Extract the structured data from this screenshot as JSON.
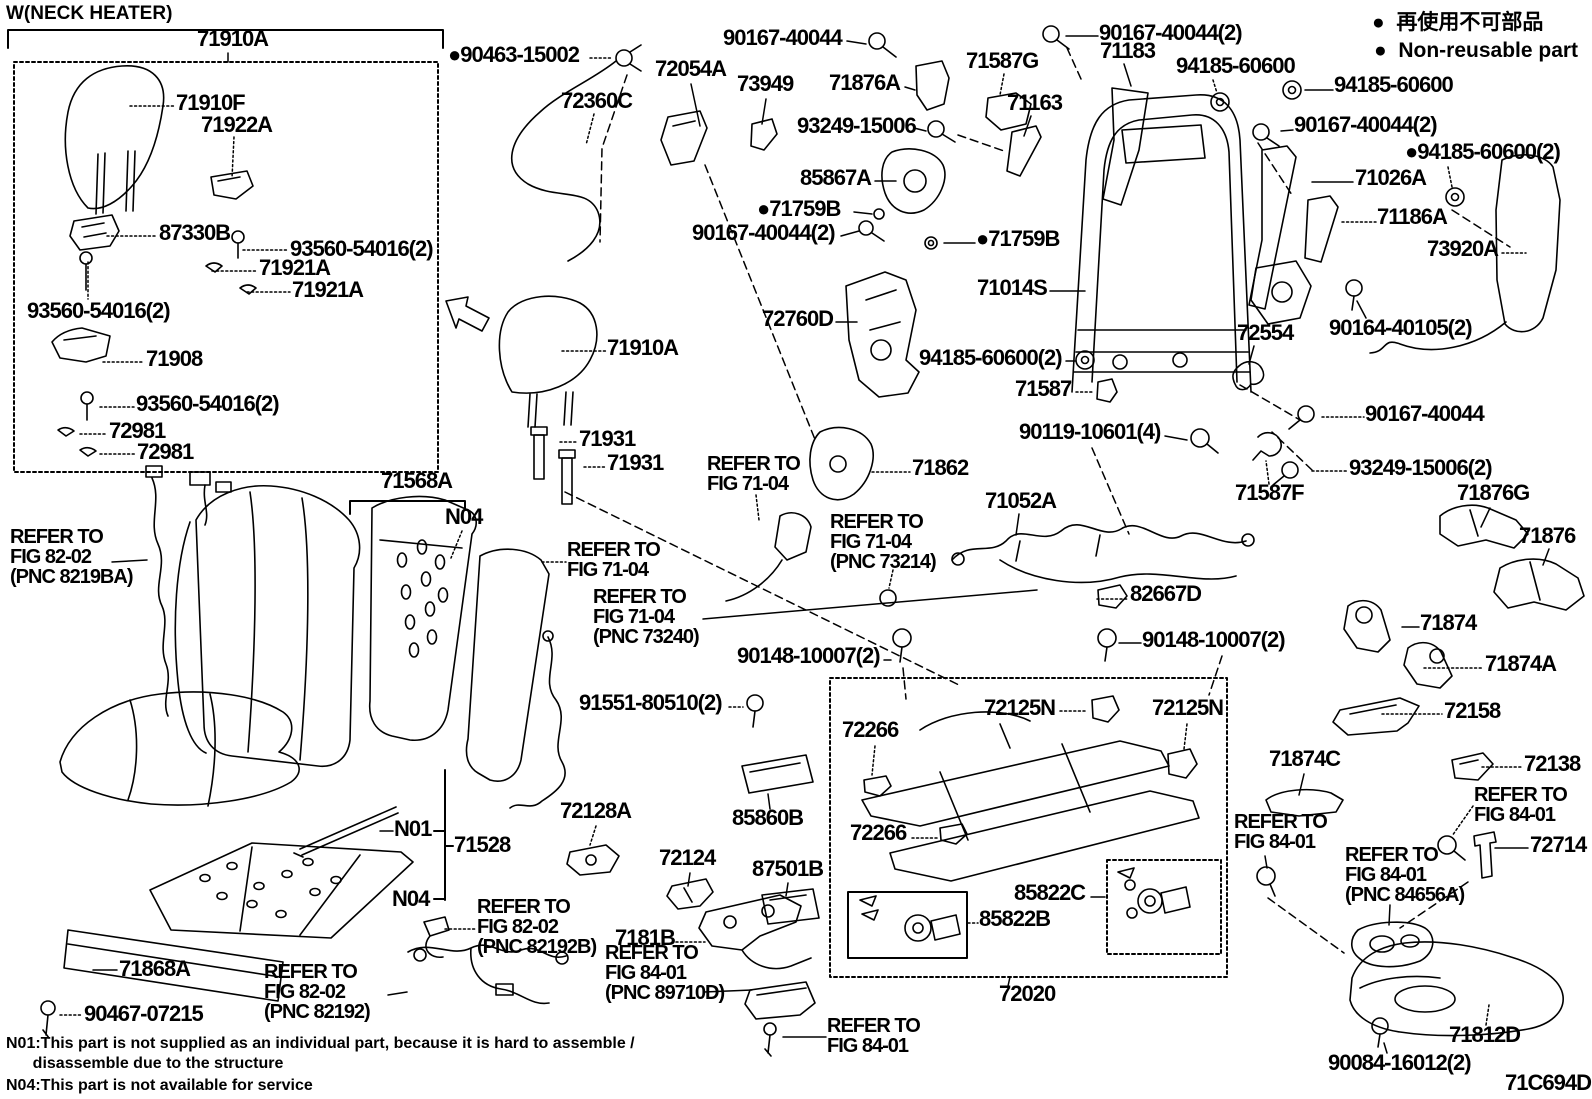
{
  "diagram_title": "Front seat & seat track exploded parts diagram",
  "figure_code": "71C694D",
  "colors": {
    "ink": "#000000",
    "background": "#ffffff"
  },
  "labels": [
    {
      "n": "title-neck-heater",
      "t": "W(NECK HEATER)",
      "x": 6,
      "y": 4,
      "fs": 19,
      "ls": 0
    },
    {
      "n": "part-71910A",
      "t": "71910A",
      "x": 197,
      "y": 28
    },
    {
      "n": "part-71910F",
      "t": "71910F",
      "x": 176,
      "y": 92
    },
    {
      "n": "part-71922A",
      "t": "71922A",
      "x": 201,
      "y": 114
    },
    {
      "n": "part-87330B",
      "t": "87330B",
      "x": 159,
      "y": 222
    },
    {
      "n": "part-93560-54016",
      "t": "93560-54016(2)",
      "x": 290,
      "y": 238
    },
    {
      "n": "part-71921A",
      "t": "71921A",
      "x": 259,
      "y": 257
    },
    {
      "n": "part-71921A",
      "t": "71921A",
      "x": 292,
      "y": 279
    },
    {
      "n": "part-93560-54016",
      "t": "93560-54016(2)",
      "x": 27,
      "y": 300
    },
    {
      "n": "part-71908",
      "t": "71908",
      "x": 146,
      "y": 348
    },
    {
      "n": "part-93560-54016",
      "t": "93560-54016(2)",
      "x": 136,
      "y": 393
    },
    {
      "n": "part-72981",
      "t": "72981",
      "x": 109,
      "y": 420
    },
    {
      "n": "part-72981",
      "t": "72981",
      "x": 137,
      "y": 441
    },
    {
      "n": "part-90463-15002",
      "t": "●90463-15002",
      "x": 448,
      "y": 44
    },
    {
      "n": "part-72360C",
      "t": "72360C",
      "x": 561,
      "y": 90
    },
    {
      "n": "part-72054A",
      "t": "72054A",
      "x": 655,
      "y": 58
    },
    {
      "n": "part-73949",
      "t": "73949",
      "x": 737,
      "y": 73
    },
    {
      "n": "part-90167-40044",
      "t": "90167-40044",
      "x": 723,
      "y": 27
    },
    {
      "n": "part-71876A",
      "t": "71876A",
      "x": 829,
      "y": 72
    },
    {
      "n": "part-71587G",
      "t": "71587G",
      "x": 966,
      "y": 50
    },
    {
      "n": "part-93249-15006",
      "t": "93249-15006",
      "x": 797,
      "y": 115
    },
    {
      "n": "part-71163",
      "t": "71163",
      "x": 1007,
      "y": 92
    },
    {
      "n": "part-85867A",
      "t": "85867A",
      "x": 800,
      "y": 167
    },
    {
      "n": "part-71759B",
      "t": "●71759B",
      "x": 757,
      "y": 198
    },
    {
      "n": "part-90167-40044",
      "t": "90167-40044(2)",
      "x": 692,
      "y": 222
    },
    {
      "n": "part-71759B",
      "t": "●71759B",
      "x": 976,
      "y": 228
    },
    {
      "n": "part-71183",
      "t": "71183",
      "x": 1100,
      "y": 40
    },
    {
      "n": "part-90167-40044",
      "t": "90167-40044(2)",
      "x": 1099,
      "y": 22
    },
    {
      "n": "part-94185-60600",
      "t": "94185-60600",
      "x": 1176,
      "y": 55
    },
    {
      "n": "part-94185-60600",
      "t": "94185-60600",
      "x": 1334,
      "y": 74
    },
    {
      "n": "part-90167-40044",
      "t": "90167-40044(2)",
      "x": 1294,
      "y": 114
    },
    {
      "n": "part-94185-60600",
      "t": "●94185-60600(2)",
      "x": 1405,
      "y": 141
    },
    {
      "n": "part-71026A",
      "t": "71026A",
      "x": 1355,
      "y": 167
    },
    {
      "n": "part-71186A",
      "t": "71186A",
      "x": 1377,
      "y": 206
    },
    {
      "n": "part-73920A",
      "t": "73920A",
      "x": 1427,
      "y": 238
    },
    {
      "n": "legend-non-reusable-jp",
      "t": "●  再使用不可部品",
      "x": 1372,
      "y": 12,
      "fs": 21,
      "ls": 0
    },
    {
      "n": "legend-non-reusable-en",
      "t": "●  Non-reusable part",
      "x": 1374,
      "y": 40,
      "fs": 21,
      "ls": 0
    },
    {
      "n": "part-71014S",
      "t": "71014S",
      "x": 977,
      "y": 277
    },
    {
      "n": "part-72760D",
      "t": "72760D",
      "x": 762,
      "y": 308
    },
    {
      "n": "part-72554",
      "t": "72554",
      "x": 1237,
      "y": 322
    },
    {
      "n": "part-90164-40105",
      "t": "90164-40105(2)",
      "x": 1329,
      "y": 317
    },
    {
      "n": "part-90167-40044",
      "t": "90167-40044",
      "x": 1365,
      "y": 403
    },
    {
      "n": "part-71587",
      "t": "71587",
      "x": 1015,
      "y": 378
    },
    {
      "n": "part-94185-60600",
      "t": "94185-60600(2)",
      "x": 919,
      "y": 347
    },
    {
      "n": "part-90119-10601",
      "t": "90119-10601(4)",
      "x": 1019,
      "y": 421
    },
    {
      "n": "part-93249-15006",
      "t": "93249-15006(2)",
      "x": 1349,
      "y": 457
    },
    {
      "n": "part-71587F",
      "t": "71587F",
      "x": 1235,
      "y": 482
    },
    {
      "n": "part-71876G",
      "t": "71876G",
      "x": 1457,
      "y": 482
    },
    {
      "n": "part-71876",
      "t": "71876",
      "x": 1519,
      "y": 525
    },
    {
      "n": "part-71862",
      "t": "71862",
      "x": 912,
      "y": 457
    },
    {
      "n": "part-71910A",
      "t": "71910A",
      "x": 607,
      "y": 337
    },
    {
      "n": "part-71931",
      "t": "71931",
      "x": 579,
      "y": 428
    },
    {
      "n": "part-71931",
      "t": "71931",
      "x": 607,
      "y": 452
    },
    {
      "n": "ref-fig-71-04",
      "t": "REFER TO\nFIG 71-04",
      "x": 707,
      "y": 454,
      "fs": 20
    },
    {
      "n": "part-71052A",
      "t": "71052A",
      "x": 985,
      "y": 490
    },
    {
      "n": "ref-fig-71-04-pnc-73214",
      "t": "REFER TO\nFIG 71-04\n(PNC 73214)",
      "x": 830,
      "y": 512,
      "fs": 20
    },
    {
      "n": "part-82667D",
      "t": "82667D",
      "x": 1130,
      "y": 583
    },
    {
      "n": "part-90148-10007",
      "t": "90148-10007(2)",
      "x": 1142,
      "y": 629
    },
    {
      "n": "part-71874",
      "t": "71874",
      "x": 1420,
      "y": 612
    },
    {
      "n": "part-71874A",
      "t": "71874A",
      "x": 1485,
      "y": 653
    },
    {
      "n": "part-72158",
      "t": "72158",
      "x": 1444,
      "y": 700
    },
    {
      "n": "ref-fig-71-04",
      "t": "REFER TO\nFIG 71-04",
      "x": 567,
      "y": 540,
      "fs": 20
    },
    {
      "n": "ref-fig-71-04-pnc-73240",
      "t": "REFER TO\nFIG 71-04\n(PNC 73240)",
      "x": 593,
      "y": 587,
      "fs": 20
    },
    {
      "n": "part-90148-10007",
      "t": "90148-10007(2)",
      "x": 737,
      "y": 645
    },
    {
      "n": "part-91551-80510",
      "t": "91551-80510(2)",
      "x": 579,
      "y": 692
    },
    {
      "n": "part-71568A",
      "t": "71568A",
      "x": 381,
      "y": 470
    },
    {
      "n": "note-n04-flag",
      "t": "N04",
      "x": 445,
      "y": 506
    },
    {
      "n": "ref-fig-82-02-pnc-8219BA",
      "t": "REFER TO\nFIG 82-02\n(PNC 8219BA)",
      "x": 10,
      "y": 527,
      "fs": 20
    },
    {
      "n": "part-72266",
      "t": "72266",
      "x": 842,
      "y": 719
    },
    {
      "n": "part-72125N",
      "t": "72125N",
      "x": 984,
      "y": 697
    },
    {
      "n": "part-72125N",
      "t": "72125N",
      "x": 1152,
      "y": 697
    },
    {
      "n": "part-71874C",
      "t": "71874C",
      "x": 1269,
      "y": 748
    },
    {
      "n": "part-72138",
      "t": "72138",
      "x": 1524,
      "y": 753
    },
    {
      "n": "ref-fig-84-01",
      "t": "REFER TO\nFIG 84-01",
      "x": 1474,
      "y": 785,
      "fs": 20
    },
    {
      "n": "part-72714",
      "t": "72714",
      "x": 1530,
      "y": 834
    },
    {
      "n": "ref-fig-84-01",
      "t": "REFER TO\nFIG 84-01",
      "x": 1234,
      "y": 812,
      "fs": 20
    },
    {
      "n": "part-72266",
      "t": "72266",
      "x": 850,
      "y": 822
    },
    {
      "n": "part-85860B",
      "t": "85860B",
      "x": 732,
      "y": 807
    },
    {
      "n": "part-72128A",
      "t": "72128A",
      "x": 560,
      "y": 800
    },
    {
      "n": "note-n01-flag",
      "t": "N01",
      "x": 394,
      "y": 818
    },
    {
      "n": "part-71528",
      "t": "71528",
      "x": 454,
      "y": 834
    },
    {
      "n": "note-n04-flag",
      "t": "N04",
      "x": 392,
      "y": 888
    },
    {
      "n": "ref-fig-82-02-pnc-82192B",
      "t": "REFER TO\nFIG 82-02\n(PNC 82192B)",
      "x": 477,
      "y": 897,
      "fs": 20
    },
    {
      "n": "part-72124",
      "t": "72124",
      "x": 659,
      "y": 847
    },
    {
      "n": "part-87501B",
      "t": "87501B",
      "x": 752,
      "y": 858
    },
    {
      "n": "part-7181B",
      "t": "7181B",
      "x": 615,
      "y": 927
    },
    {
      "n": "part-85822C",
      "t": "85822C",
      "x": 1014,
      "y": 882
    },
    {
      "n": "part-85822B",
      "t": "85822B",
      "x": 979,
      "y": 908
    },
    {
      "n": "ref-fig-84-01-pnc-89710D",
      "t": "REFER TO\nFIG 84-01\n(PNC 89710D)",
      "x": 605,
      "y": 943,
      "fs": 20
    },
    {
      "n": "ref-fig-84-01",
      "t": "REFER TO\nFIG 84-01",
      "x": 827,
      "y": 1016,
      "fs": 20
    },
    {
      "n": "part-72020",
      "t": "72020",
      "x": 999,
      "y": 983
    },
    {
      "n": "ref-fig-84-01-pnc-84656A",
      "t": "REFER TO\nFIG 84-01\n(PNC 84656A)",
      "x": 1345,
      "y": 845,
      "fs": 20
    },
    {
      "n": "part-71868A",
      "t": "71868A",
      "x": 119,
      "y": 958
    },
    {
      "n": "part-90467-07215",
      "t": "90467-07215",
      "x": 84,
      "y": 1003
    },
    {
      "n": "ref-fig-82-02-pnc-82192",
      "t": "REFER TO\nFIG 82-02\n(PNC 82192)",
      "x": 264,
      "y": 962,
      "fs": 20
    },
    {
      "n": "part-71812D",
      "t": "71812D",
      "x": 1449,
      "y": 1024
    },
    {
      "n": "part-90084-16012",
      "t": "90084-16012(2)",
      "x": 1328,
      "y": 1052
    },
    {
      "n": "figure-code",
      "t": "71C694D",
      "x": 1505,
      "y": 1072
    },
    {
      "n": "note-n01-text",
      "t": "N01:This part is not supplied as an individual part, because it is hard to assemble /",
      "x": 6,
      "y": 1036,
      "fs": 16,
      "ls": 0
    },
    {
      "n": "note-n01-text",
      "t": "      disassemble due to the structure",
      "x": 6,
      "y": 1056,
      "fs": 16,
      "ls": 0
    },
    {
      "n": "note-n04-text",
      "t": "N04:This part is not available for service",
      "x": 6,
      "y": 1078,
      "fs": 16,
      "ls": 0
    }
  ]
}
